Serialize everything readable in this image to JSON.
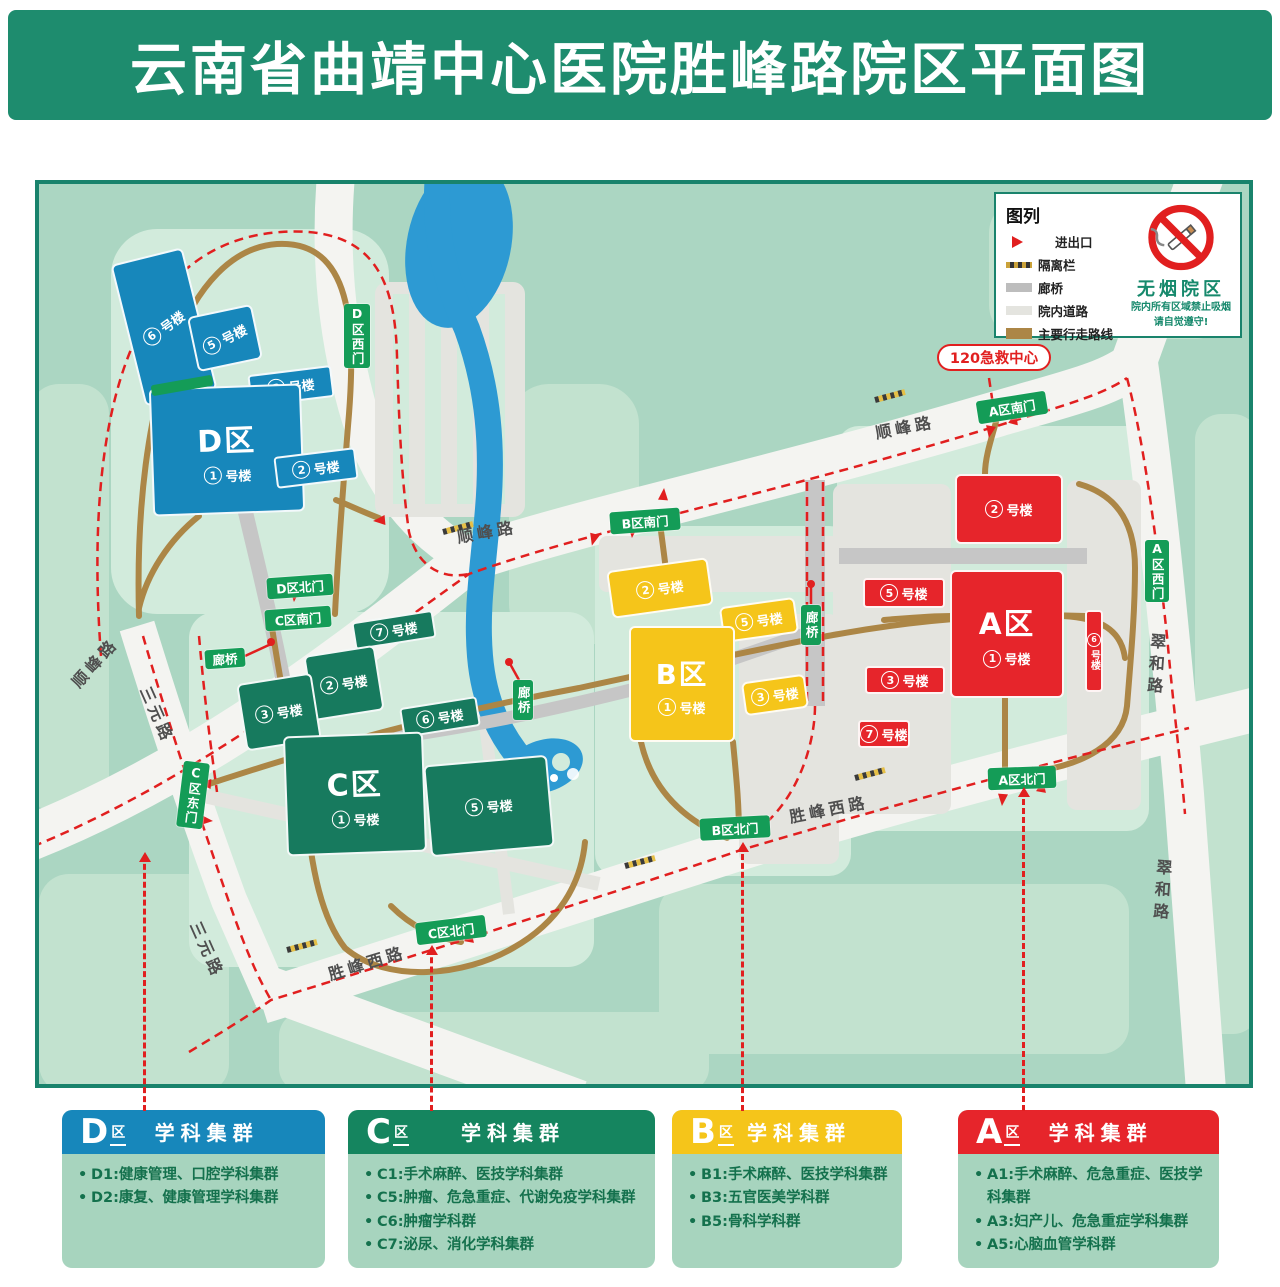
{
  "title": "云南省曲靖中心医院胜峰路院区平面图",
  "emergency_label": "120急救中心",
  "colors": {
    "banner": "#1e8c6e",
    "map_border": "#19836c",
    "gate_green": "#149c57",
    "route_brown": "#ac8646",
    "route_red": "#e11f1f",
    "river_blue": "#2d9ad3",
    "zone": {
      "D": "#1787bb",
      "C": "#177a5e",
      "B": "#f5c51a",
      "A": "#e6252b"
    }
  },
  "legend": {
    "title": "图列",
    "items": [
      {
        "id": "entrance",
        "label": "进出口"
      },
      {
        "id": "barrier",
        "label": "隔离栏"
      },
      {
        "id": "bridge",
        "label": "廊桥"
      },
      {
        "id": "roads",
        "label": "院内道路"
      },
      {
        "id": "route",
        "label": "主要行走路线"
      }
    ]
  },
  "no_smoking": {
    "title": "无烟院区",
    "line1": "院内所有区域禁止吸烟",
    "line2": "请自觉遵守!"
  },
  "map": {
    "zone_suffix": "区",
    "building_suffix": "号楼",
    "buildings": [
      {
        "id": "d6",
        "zone": "D",
        "n": "6",
        "x": 88,
        "y": 70,
        "w": 74,
        "h": 146,
        "rot": -14,
        "lr": -22
      },
      {
        "id": "d5",
        "zone": "D",
        "n": "5",
        "x": 153,
        "y": 126,
        "w": 66,
        "h": 56,
        "rot": -12,
        "lr": -15
      },
      {
        "id": "d3",
        "zone": "D",
        "n": "3",
        "x": 210,
        "y": 186,
        "w": 84,
        "h": 32,
        "rot": -7
      },
      {
        "id": "d1",
        "zone": "D",
        "n": "1",
        "x": 112,
        "y": 202,
        "w": 152,
        "h": 128,
        "rot": -2,
        "main": 1
      },
      {
        "id": "d2",
        "zone": "D",
        "n": "2",
        "x": 236,
        "y": 268,
        "w": 82,
        "h": 32,
        "rot": -7
      },
      {
        "id": "c7",
        "zone": "C",
        "n": "7",
        "x": 314,
        "y": 432,
        "w": 82,
        "h": 28,
        "rot": -9
      },
      {
        "id": "c2",
        "zone": "C",
        "n": "2",
        "x": 269,
        "y": 466,
        "w": 72,
        "h": 66,
        "rot": -9
      },
      {
        "id": "c3",
        "zone": "C",
        "n": "3",
        "x": 202,
        "y": 494,
        "w": 76,
        "h": 68,
        "rot": -9
      },
      {
        "id": "c6",
        "zone": "C",
        "n": "6",
        "x": 362,
        "y": 518,
        "w": 78,
        "h": 30,
        "rot": -9
      },
      {
        "id": "c1",
        "zone": "C",
        "n": "1",
        "x": 246,
        "y": 550,
        "w": 140,
        "h": 120,
        "rot": -2,
        "main": 1
      },
      {
        "id": "c5",
        "zone": "C",
        "n": "5",
        "x": 388,
        "y": 576,
        "w": 124,
        "h": 92,
        "rot": -5
      },
      {
        "id": "b2",
        "zone": "B",
        "n": "2",
        "x": 570,
        "y": 380,
        "w": 102,
        "h": 48,
        "rot": -8
      },
      {
        "id": "b5",
        "zone": "B",
        "n": "5",
        "x": 682,
        "y": 418,
        "w": 76,
        "h": 36,
        "rot": -8
      },
      {
        "id": "b1",
        "zone": "B",
        "n": "1",
        "x": 590,
        "y": 442,
        "w": 106,
        "h": 116,
        "rot": 0,
        "main": 1
      },
      {
        "id": "b3",
        "zone": "B",
        "n": "3",
        "x": 704,
        "y": 494,
        "w": 64,
        "h": 34,
        "rot": -8
      },
      {
        "id": "a2",
        "zone": "A",
        "n": "2",
        "x": 916,
        "y": 290,
        "w": 108,
        "h": 70,
        "rot": 0
      },
      {
        "id": "a5",
        "zone": "A",
        "n": "5",
        "x": 824,
        "y": 394,
        "w": 82,
        "h": 30,
        "rot": 0
      },
      {
        "id": "a1",
        "zone": "A",
        "n": "1",
        "x": 911,
        "y": 386,
        "w": 114,
        "h": 128,
        "rot": 0,
        "main": 1
      },
      {
        "id": "a6",
        "zone": "A",
        "n": "6",
        "x": 1046,
        "y": 426,
        "w": 18,
        "h": 82,
        "rot": 0,
        "v": 1
      },
      {
        "id": "a3",
        "zone": "A",
        "n": "3",
        "x": 826,
        "y": 482,
        "w": 80,
        "h": 28,
        "rot": 0
      },
      {
        "id": "a7",
        "zone": "A",
        "n": "7",
        "x": 819,
        "y": 536,
        "w": 52,
        "h": 28,
        "rot": 0
      }
    ],
    "gates": [
      {
        "id": "d-west-gate",
        "t": "D区西门",
        "x": 305,
        "y": 120,
        "w": 26,
        "h": 64,
        "v": 1
      },
      {
        "id": "d-north-gate",
        "t": "D区北门",
        "x": 228,
        "y": 392,
        "w": 66,
        "h": 21,
        "r": -4
      },
      {
        "id": "c-south-gate",
        "t": "C区南门",
        "x": 226,
        "y": 424,
        "w": 66,
        "h": 21,
        "r": -4
      },
      {
        "id": "c-east-gate",
        "t": "C区东门",
        "x": 141,
        "y": 578,
        "w": 26,
        "h": 66,
        "v": 1,
        "r": 7
      },
      {
        "id": "c-north-gate",
        "t": "C区北门",
        "x": 377,
        "y": 735,
        "w": 70,
        "h": 22,
        "r": -7
      },
      {
        "id": "b-south-gate",
        "t": "B区南门",
        "x": 571,
        "y": 326,
        "w": 70,
        "h": 22,
        "r": -4
      },
      {
        "id": "b-north-gate",
        "t": "B区北门",
        "x": 661,
        "y": 633,
        "w": 70,
        "h": 22,
        "r": -3
      },
      {
        "id": "a-south-gate",
        "t": "A区南门",
        "x": 938,
        "y": 212,
        "w": 70,
        "h": 23,
        "r": -9
      },
      {
        "id": "a-west-gate",
        "t": "A区西门",
        "x": 1106,
        "y": 356,
        "w": 24,
        "h": 62,
        "v": 1
      },
      {
        "id": "a-north-gate",
        "t": "A区北门",
        "x": 949,
        "y": 583,
        "w": 68,
        "h": 22,
        "r": -2
      }
    ],
    "bridges": [
      {
        "id": "bridge-label-1",
        "t": "廊桥",
        "x": 166,
        "y": 465,
        "w": 40,
        "h": 19,
        "r": -4
      },
      {
        "id": "bridge-label-2",
        "t": "廊桥",
        "x": 474,
        "y": 496,
        "w": 20,
        "h": 40,
        "v": 1
      },
      {
        "id": "bridge-label-3",
        "t": "廊桥",
        "x": 762,
        "y": 421,
        "w": 20,
        "h": 40,
        "v": 1
      }
    ],
    "roads": [
      {
        "id": "shunfeng-left",
        "t": "顺峰路",
        "x": 26,
        "y": 492,
        "r": -48
      },
      {
        "id": "shunfeng-mid",
        "t": "顺峰路",
        "x": 416,
        "y": 340,
        "r": -10
      },
      {
        "id": "shunfeng-right",
        "t": "顺峰路",
        "x": 834,
        "y": 236,
        "r": -11
      },
      {
        "id": "sanyuan-top",
        "t": "三元路",
        "x": 118,
        "y": 498,
        "r": 66
      },
      {
        "id": "sanyuan-bottom",
        "t": "三元路",
        "x": 168,
        "y": 733,
        "r": 66
      },
      {
        "id": "shengfengxi-left",
        "t": "胜峰西路",
        "x": 286,
        "y": 778,
        "r": -17
      },
      {
        "id": "shengfengxi-right",
        "t": "胜峰西路",
        "x": 748,
        "y": 620,
        "r": -11
      },
      {
        "id": "cuihe-top",
        "t": "翠和路",
        "x": 1106,
        "y": 448,
        "v": 1,
        "r": 4
      },
      {
        "id": "cuihe-bottom",
        "t": "翠和路",
        "x": 1112,
        "y": 674,
        "v": 1,
        "r": 4
      }
    ]
  },
  "connectors": [
    {
      "zone": "D",
      "x": 143,
      "top": 855,
      "h": 256
    },
    {
      "zone": "C",
      "x": 430,
      "top": 948,
      "h": 163
    },
    {
      "zone": "B",
      "x": 741,
      "top": 845,
      "h": 266
    },
    {
      "zone": "A",
      "x": 1022,
      "top": 790,
      "h": 321
    }
  ],
  "panels": [
    {
      "id": "panel-d",
      "letter": "D",
      "title": "学科集群",
      "color": "#1787bb",
      "x": 62,
      "w": 263,
      "items": [
        "D1:健康管理、口腔学科集群",
        "D2:康复、健康管理学科集群"
      ]
    },
    {
      "id": "panel-c",
      "letter": "C",
      "title": "学科集群",
      "color": "#15855f",
      "x": 348,
      "w": 307,
      "items": [
        "C1:手术麻醉、医技学科集群",
        "C5:肿瘤、危急重症、代谢免疫学科集群",
        "C6:肿瘤学科群",
        "C7:泌尿、消化学科集群"
      ]
    },
    {
      "id": "panel-b",
      "letter": "B",
      "title": "学科集群",
      "color": "#f5c51a",
      "x": 672,
      "w": 230,
      "items": [
        "B1:手术麻醉、医技学科集群",
        "B3:五官医美学科群",
        "B5:骨科学科群"
      ]
    },
    {
      "id": "panel-a",
      "letter": "A",
      "title": "学科集群",
      "color": "#e6252b",
      "x": 958,
      "w": 261,
      "items": [
        "A1:手术麻醉、危急重症、医技学科集群",
        "A3:妇产儿、危急重症学科集群",
        "A5:心脑血管学科群"
      ]
    }
  ]
}
